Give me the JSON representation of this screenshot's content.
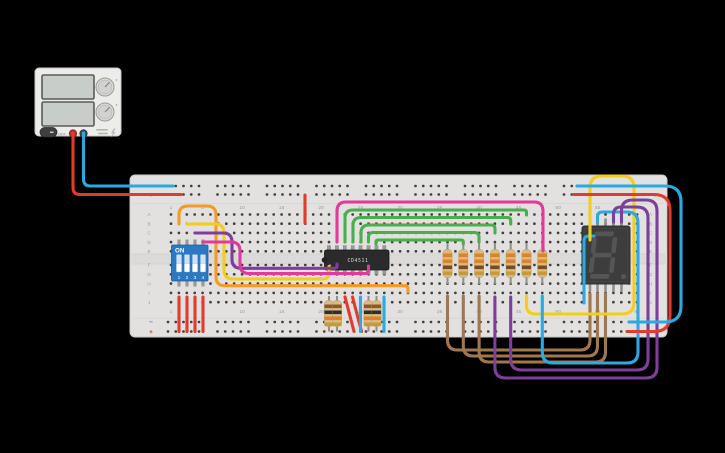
{
  "scene": {
    "background": "#000000"
  },
  "power_supply": {
    "off_label": "OFF",
    "body_color": "#ececea",
    "screen_color": "#c9cdc9",
    "knob_color": "#d9d9d7",
    "positive_terminal_color": "#c3302a",
    "negative_terminal_color": "#4a4a4a"
  },
  "breadboard": {
    "body_color": "#e2e1df",
    "hole_color": "#3f3f3f",
    "label_color": "#9b9b9b",
    "column_labels": [
      "1",
      "5",
      "10",
      "15",
      "20",
      "25",
      "30",
      "35",
      "40",
      "45",
      "50",
      "55",
      "60"
    ],
    "column_label_positions": [
      1,
      5,
      10,
      15,
      20,
      25,
      30,
      35,
      40,
      45,
      50,
      55,
      60
    ],
    "row_letters_top": [
      "A",
      "B",
      "C",
      "D",
      "E"
    ],
    "row_letters_bottom": [
      "F",
      "G",
      "H",
      "I",
      "J"
    ],
    "rail_minus": "−",
    "rail_plus": "+",
    "rail_minus_color": "#2a7fb8",
    "rail_plus_color": "#c0392b"
  },
  "dip_switch": {
    "on_label": "ON",
    "switch_numbers": [
      "1",
      "2",
      "3",
      "4"
    ],
    "body_color": "#2c79c2"
  },
  "ic": {
    "label": "CD4511",
    "body_color": "#2b2b2b",
    "label_color": "#d8d8d8"
  },
  "seven_segment": {
    "digit_shown": "8",
    "decimal_point": true,
    "body_color": "#3d3d3d",
    "segment_color": "#555555"
  },
  "resistors": {
    "top_row": {
      "count": 7,
      "body_color": "#d9bc85",
      "band_colors": [
        "#e0821f",
        "#e0821f",
        "#7a4a21",
        "#c49a3c"
      ],
      "positions_x": [
        447.5,
        463.3,
        479.1,
        494.9,
        510.7,
        526.5,
        542.3
      ]
    },
    "bottom": {
      "count": 4,
      "body_color": "#d9bc85",
      "band_colors": [
        "#8a5a2b",
        "#2e2e2e",
        "#e0821f",
        "#c49a3c"
      ],
      "positions_x": [
        329,
        337,
        368.5,
        376.5
      ]
    }
  },
  "wires": [
    {
      "name": "magenta-arc-wire",
      "color": "#e23a9b",
      "r": 9,
      "points": [
        [
          337,
          242
        ],
        [
          337,
          202
        ],
        [
          543,
          202
        ],
        [
          543,
          251
        ]
      ]
    },
    {
      "name": "green-wire-1",
      "color": "#4aae4f",
      "r": 8,
      "points": [
        [
          345,
          242
        ],
        [
          345,
          210
        ],
        [
          526.5,
          210
        ],
        [
          526.5,
          215
        ]
      ]
    },
    {
      "name": "green-wire-2",
      "color": "#4aae4f",
      "r": 8,
      "points": [
        [
          353,
          242
        ],
        [
          353,
          217.5
        ],
        [
          510.7,
          217.5
        ],
        [
          510.7,
          224
        ]
      ]
    },
    {
      "name": "green-wire-3",
      "color": "#4aae4f",
      "r": 8,
      "points": [
        [
          361,
          242
        ],
        [
          361,
          225
        ],
        [
          495,
          225
        ],
        [
          495,
          233
        ]
      ]
    },
    {
      "name": "green-wire-4",
      "color": "#4aae4f",
      "r": 8,
      "points": [
        [
          368.5,
          242
        ],
        [
          368.5,
          232.5
        ],
        [
          479,
          232.5
        ],
        [
          479,
          242
        ]
      ]
    },
    {
      "name": "green-wire-5",
      "color": "#4aae4f",
      "r": 5,
      "points": [
        [
          376,
          244
        ],
        [
          376,
          240
        ],
        [
          463.3,
          240
        ],
        [
          463.3,
          244
        ]
      ]
    },
    {
      "name": "orange-wire",
      "color": "#f59b21",
      "r": 9,
      "points": [
        [
          179,
          224
        ],
        [
          179,
          206
        ],
        [
          216,
          206
        ],
        [
          216,
          285.7
        ],
        [
          408,
          285.7
        ],
        [
          408,
          292
        ]
      ]
    },
    {
      "name": "yellow-dip-wire",
      "color": "#f2ce1b",
      "r": 9,
      "points": [
        [
          187,
          224
        ],
        [
          224,
          224
        ],
        [
          224,
          279
        ],
        [
          329,
          279
        ],
        [
          329,
          266.5
        ]
      ]
    },
    {
      "name": "purple-dip-wire",
      "color": "#7d3f98",
      "r": 9,
      "points": [
        [
          195,
          233
        ],
        [
          232,
          233
        ],
        [
          232,
          268.3
        ],
        [
          337,
          268.3
        ],
        [
          337,
          264
        ]
      ]
    },
    {
      "name": "magenta-dip-wire",
      "color": "#e23a9b",
      "r": 9,
      "points": [
        [
          203,
          242
        ],
        [
          240,
          242
        ],
        [
          240,
          273.5
        ],
        [
          368.5,
          273.5
        ],
        [
          368.5,
          266
        ]
      ]
    },
    {
      "name": "psu-positive-wire",
      "color": "#e23b2e",
      "r": 7,
      "points": [
        [
          73,
          133
        ],
        [
          73,
          194.5
        ],
        [
          181,
          194.5
        ]
      ]
    },
    {
      "name": "psu-negative-wire",
      "color": "#2ba9e0",
      "r": 7,
      "points": [
        [
          83.5,
          133
        ],
        [
          83.5,
          186
        ],
        [
          173,
          186
        ]
      ]
    },
    {
      "name": "power-red-stub",
      "color": "#e23b2e",
      "r": 4,
      "points": [
        [
          305,
          195
        ],
        [
          305,
          223
        ]
      ]
    },
    {
      "name": "dip-red-wire-1",
      "color": "#e23b2e",
      "r": 4,
      "points": [
        [
          179,
          297
        ],
        [
          179,
          331.5
        ]
      ]
    },
    {
      "name": "dip-red-wire-2",
      "color": "#e23b2e",
      "r": 4,
      "points": [
        [
          187,
          297
        ],
        [
          187,
          331.5
        ]
      ]
    },
    {
      "name": "dip-red-wire-3",
      "color": "#e23b2e",
      "r": 4,
      "points": [
        [
          195,
          297
        ],
        [
          195,
          331.5
        ]
      ]
    },
    {
      "name": "dip-red-wire-4",
      "color": "#e23b2e",
      "r": 4,
      "points": [
        [
          203,
          297
        ],
        [
          203,
          331.5
        ]
      ]
    },
    {
      "name": "red-diagonal-1",
      "color": "#e23b2e",
      "r": 4,
      "points": [
        [
          345,
          297
        ],
        [
          354,
          331.5
        ]
      ]
    },
    {
      "name": "red-diagonal-2",
      "color": "#e23b2e",
      "r": 4,
      "points": [
        [
          352.5,
          297
        ],
        [
          361.5,
          331.5
        ]
      ]
    },
    {
      "name": "blue-wire-short-1",
      "color": "#2ba9e0",
      "r": 4,
      "points": [
        [
          360.5,
          297
        ],
        [
          360.5,
          331.5
        ]
      ]
    },
    {
      "name": "blue-wire-short-2",
      "color": "#2ba9e0",
      "r": 4,
      "points": [
        [
          384,
          297
        ],
        [
          384,
          331.5
        ]
      ]
    },
    {
      "name": "brown-wire-1",
      "color": "#a3774e",
      "r": 10,
      "points": [
        [
          447.5,
          296
        ],
        [
          447.5,
          350
        ],
        [
          590,
          350
        ],
        [
          590,
          294
        ]
      ]
    },
    {
      "name": "brown-wire-2",
      "color": "#a3774e",
      "r": 10,
      "points": [
        [
          463.3,
          296
        ],
        [
          463.3,
          356
        ],
        [
          597.5,
          356
        ],
        [
          597.5,
          294
        ]
      ]
    },
    {
      "name": "brown-wire-3",
      "color": "#a3774e",
      "r": 10,
      "points": [
        [
          479.1,
          296
        ],
        [
          479.1,
          362
        ],
        [
          605.5,
          362
        ],
        [
          605.5,
          294
        ]
      ]
    },
    {
      "name": "cyan-short-wire",
      "color": "#2ba9e0",
      "r": 6,
      "points": [
        [
          594,
          236
        ],
        [
          584,
          236
        ],
        [
          584,
          303
        ]
      ]
    },
    {
      "name": "yellow-display-wire",
      "color": "#f2ce1b",
      "r": 12,
      "points": [
        [
          590,
          240
        ],
        [
          590,
          176
        ],
        [
          634,
          176
        ],
        [
          634,
          314
        ],
        [
          526.5,
          314
        ],
        [
          526.5,
          296
        ]
      ]
    },
    {
      "name": "cyan-display-wire",
      "color": "#2ba9e0",
      "r": 11,
      "points": [
        [
          597.5,
          222
        ],
        [
          597.5,
          212
        ],
        [
          638,
          212
        ],
        [
          638,
          363
        ],
        [
          542.3,
          363
        ],
        [
          542.3,
          296
        ]
      ]
    },
    {
      "name": "purple-display-wire-1",
      "color": "#7d3f98",
      "r": 11,
      "points": [
        [
          613.5,
          222
        ],
        [
          613.5,
          207
        ],
        [
          648,
          207
        ],
        [
          648,
          370
        ],
        [
          510.7,
          370
        ],
        [
          510.7,
          297
        ]
      ]
    },
    {
      "name": "purple-display-wire-2",
      "color": "#7d3f98",
      "r": 11,
      "points": [
        [
          621.5,
          222
        ],
        [
          621.5,
          200
        ],
        [
          657,
          200
        ],
        [
          657,
          378
        ],
        [
          494.9,
          378
        ],
        [
          494.9,
          297
        ]
      ]
    },
    {
      "name": "rail-red-loop",
      "color": "#e23b2e",
      "r": 16,
      "points": [
        [
          574,
          194.5
        ],
        [
          670,
          194.5
        ],
        [
          670,
          331.5
        ],
        [
          627,
          331.5
        ]
      ]
    },
    {
      "name": "rail-blue-loop",
      "color": "#2ba9e0",
      "r": 16,
      "points": [
        [
          577,
          186
        ],
        [
          681,
          186
        ],
        [
          681,
          322
        ],
        [
          629,
          322
        ]
      ]
    }
  ]
}
